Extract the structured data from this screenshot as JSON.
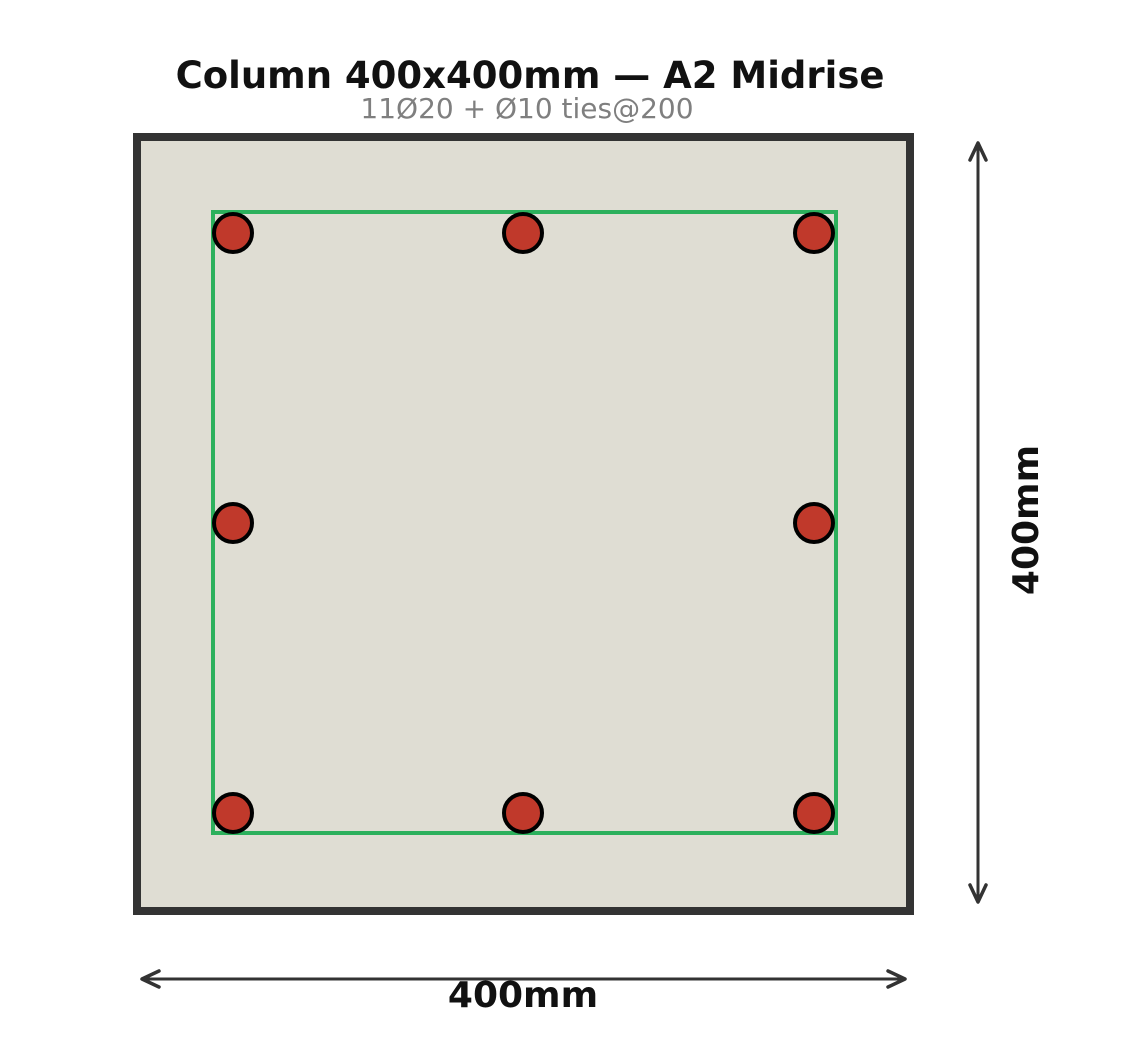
{
  "header": {
    "title": "Column 400x400mm — A2 Midrise",
    "subtitle": "11Ø20 + Ø10 ties@200"
  },
  "dimensions": {
    "width_label": "400mm",
    "height_label": "400mm"
  },
  "section": {
    "concrete_fill": "#dfddd3",
    "outline_color": "#333333",
    "tie_color": "#2cb05c",
    "rebar_fill": "#c0392b",
    "rebar_stroke": "#000000",
    "dimension_color": "#333333",
    "subtitle_color": "#7f7f7f"
  },
  "rebar": {
    "count_visible": 8,
    "radius": 19,
    "bars": [
      {
        "cx": 233,
        "cy": 233
      },
      {
        "cx": 523,
        "cy": 233
      },
      {
        "cx": 814,
        "cy": 233
      },
      {
        "cx": 233,
        "cy": 523
      },
      {
        "cx": 814,
        "cy": 523
      },
      {
        "cx": 233,
        "cy": 813
      },
      {
        "cx": 523,
        "cy": 813
      },
      {
        "cx": 814,
        "cy": 813
      }
    ]
  }
}
